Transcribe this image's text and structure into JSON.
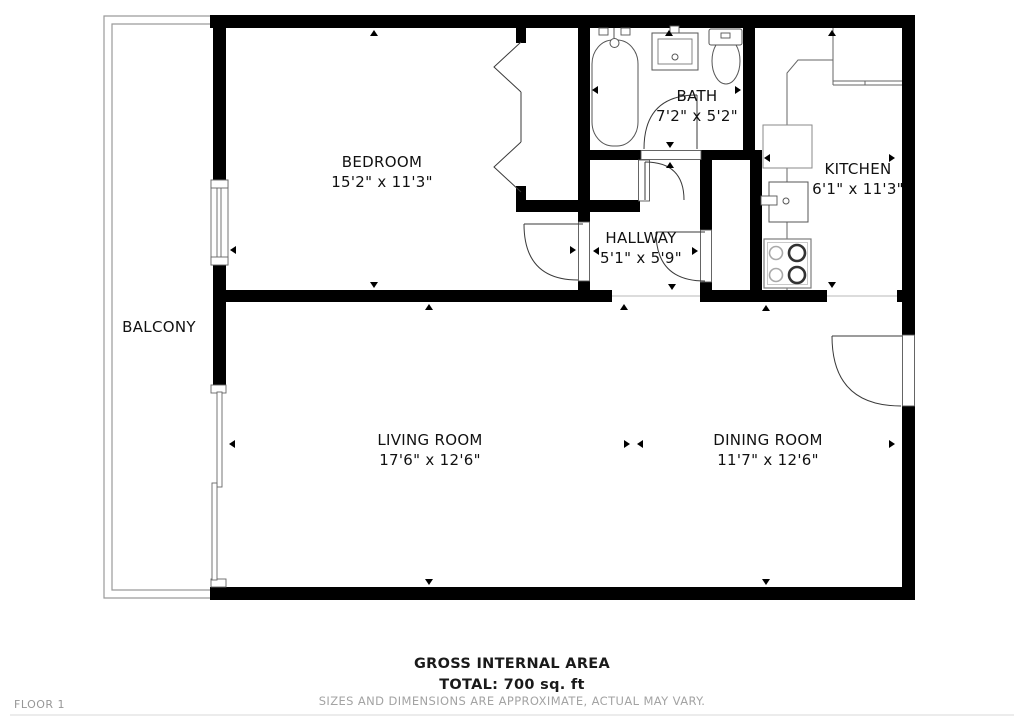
{
  "rooms": {
    "balcony": {
      "name": "BALCONY",
      "dims": ""
    },
    "bedroom": {
      "name": "BEDROOM",
      "dims": "15'2\" x 11'3\""
    },
    "bath": {
      "name": "BATH",
      "dims": "7'2\" x 5'2\""
    },
    "hallway": {
      "name": "HALLWAY",
      "dims": "5'1\" x 5'9\""
    },
    "kitchen": {
      "name": "KITCHEN",
      "dims": "6'1\" x 11'3\""
    },
    "living_room": {
      "name": "LIVING ROOM",
      "dims": "17'6\" x 12'6\""
    },
    "dining_room": {
      "name": "DINING ROOM",
      "dims": "11'7\" x 12'6\""
    }
  },
  "footer": {
    "area_title": "GROSS INTERNAL AREA",
    "total": "TOTAL: 700 sq. ft",
    "disclaimer": "SIZES AND DIMENSIONS ARE APPROXIMATE, ACTUAL MAY VARY.",
    "floor_label": "FLOOR 1"
  },
  "colors": {
    "wall": "#000000",
    "fixture_line": "#4f4f4f",
    "balcony_line": "#9a9a9a",
    "muted_text": "#a3a3a3",
    "background": "#ffffff"
  }
}
